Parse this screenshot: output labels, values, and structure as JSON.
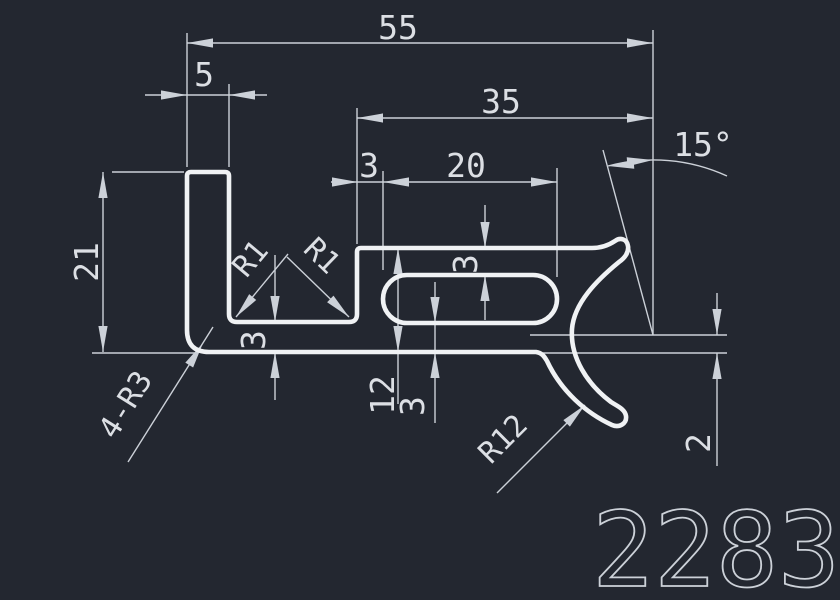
{
  "drawing": {
    "part_number": "2283",
    "colors": {
      "background": "#232730",
      "line": "#f0f2f4",
      "thin": "#ccd1d8",
      "text": "#dcdfe4"
    },
    "dimensions": {
      "overall_width": "55",
      "leg_width": "5",
      "right_width": "35",
      "step_wall": "3",
      "slot_length": "20",
      "tip_angle": "15°",
      "leg_height": "21",
      "section_height": "12",
      "slot_bottom_wall": "3",
      "slot_top_wall": "3",
      "arm_thickness": "3",
      "tip_offset": "2",
      "fillet_left": "R1",
      "fillet_right": "R1",
      "corner_fillets": "4-R3",
      "hook_radius": "R12"
    }
  }
}
